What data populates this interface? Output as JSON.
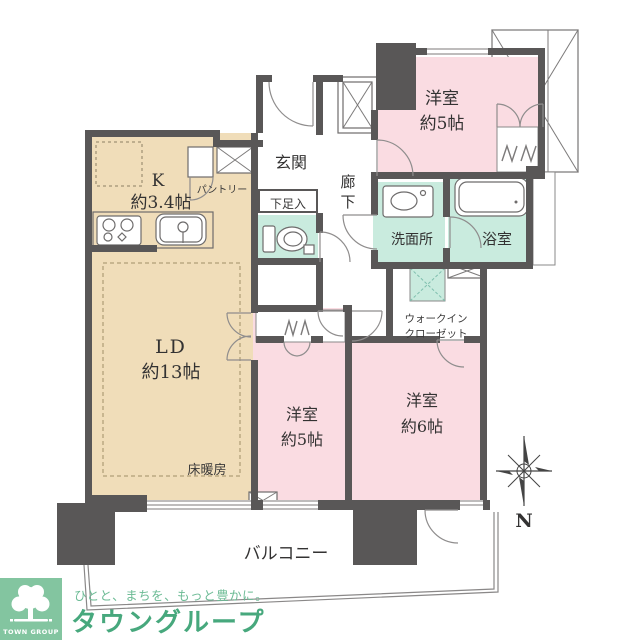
{
  "floorplan": {
    "rooms": {
      "kitchen_name": "K",
      "kitchen_size": "約3.4帖",
      "pantry": "パントリー",
      "ld_name": "LD",
      "ld_size": "約13帖",
      "floor_heating": "床暖房",
      "entrance": "玄関",
      "shoe_cabinet": "下足入",
      "hallway_char1": "廊",
      "hallway_char2": "下",
      "washroom": "洗面所",
      "bathroom": "浴室",
      "bedroom_north_name": "洋室",
      "bedroom_north_size": "約5帖",
      "bedroom_center_name": "洋室",
      "bedroom_center_size": "約5帖",
      "bedroom_east_name": "洋室",
      "bedroom_east_size": "約6帖",
      "wic_line1": "ウォークイン",
      "wic_line2": "クローゼット",
      "balcony": "バルコニー"
    },
    "compass_label": "N",
    "colors": {
      "wall": "#595757",
      "ldk_fill": "#F0DDB9",
      "bedroom_fill": "#FADCE2",
      "wet_area_fill": "#C9EBDE",
      "brand_green": "#47A87D",
      "logo_background": "#83C5A0"
    }
  },
  "footer": {
    "logo_label": "TOWN GROUP",
    "slogan": "ひとと、まちを、もっと豊かに。",
    "brand": "タウングループ"
  }
}
